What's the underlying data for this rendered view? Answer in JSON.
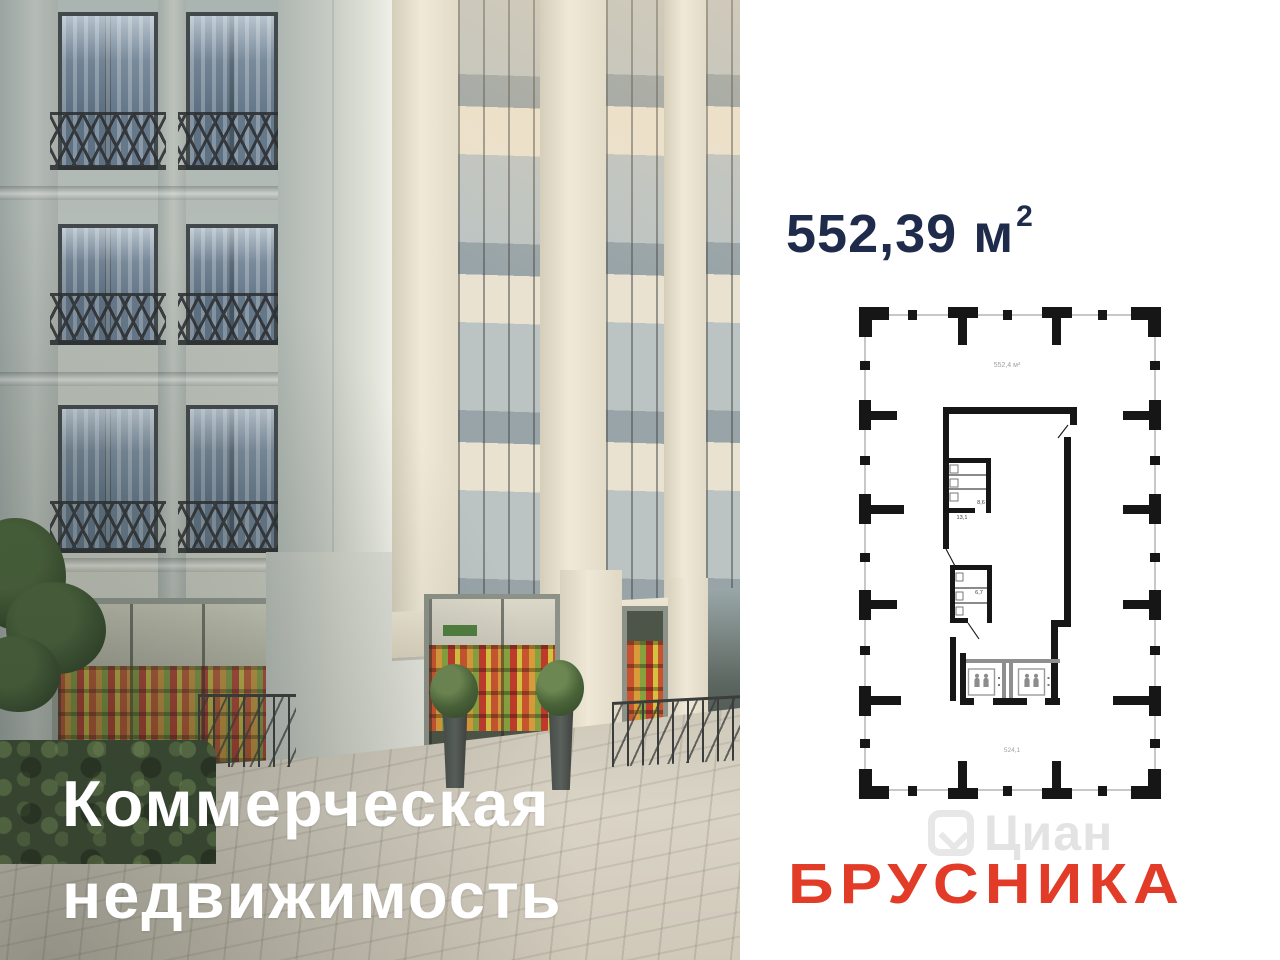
{
  "headline": {
    "line1": "Коммерческая",
    "line2": "недвижимость"
  },
  "area": {
    "value": "552,39",
    "unit": "м",
    "sup": "2"
  },
  "floorplan": {
    "area_top": "552,4 м²",
    "room_small": "8,6",
    "room_large": "13,1",
    "room_mid": "6,7",
    "area_bottom": "524,1"
  },
  "watermark": {
    "text": "Циан"
  },
  "brand": {
    "name": "БРУСНИКА"
  },
  "colors": {
    "title_navy": "#1f2b4a",
    "brand_red": "#e23b28",
    "plan_wall": "#161616",
    "plan_outline": "#ababab",
    "headline_white": "#ffffff"
  },
  "icons": {
    "elevator": "elevator-passengers-icon",
    "watermark_logo": "cian-logo-icon"
  }
}
